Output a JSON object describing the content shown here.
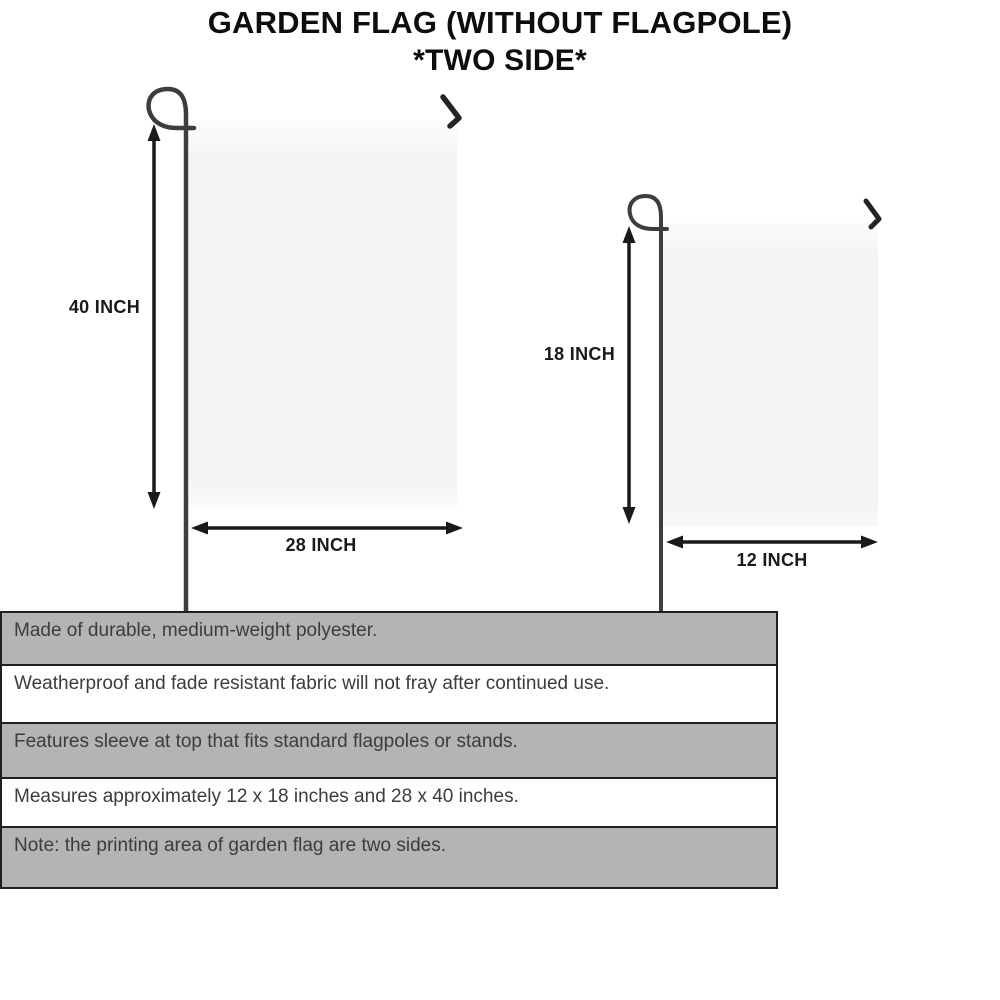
{
  "title": {
    "line1": "GARDEN FLAG (WITHOUT FLAGPOLE)",
    "line2": "*TWO SIDE*"
  },
  "diagram": {
    "large_flag": {
      "height_label": "40 INCH",
      "width_label": "28 INCH"
    },
    "small_flag": {
      "height_label": "18 INCH",
      "width_label": "12 INCH"
    }
  },
  "specs": {
    "rows": [
      "Made of durable, medium-weight polyester.",
      "Weatherproof and fade resistant fabric will not fray after continued use.",
      "Features sleeve at top that fits standard flagpoles or stands.",
      "Measures approximately 12 x 18 inches and 28 x 40 inches.",
      "Note: the printing area of garden flag are two sides."
    ]
  },
  "colors": {
    "row_gray": "#b4b4b4",
    "row_border": "#1f1f1f",
    "flag_fill": "#f4f4f4",
    "pole": "#3d3d3d",
    "arrow": "#1a1a1a",
    "title_text": "#0d0d0d",
    "spec_text": "#3c3c3c"
  }
}
